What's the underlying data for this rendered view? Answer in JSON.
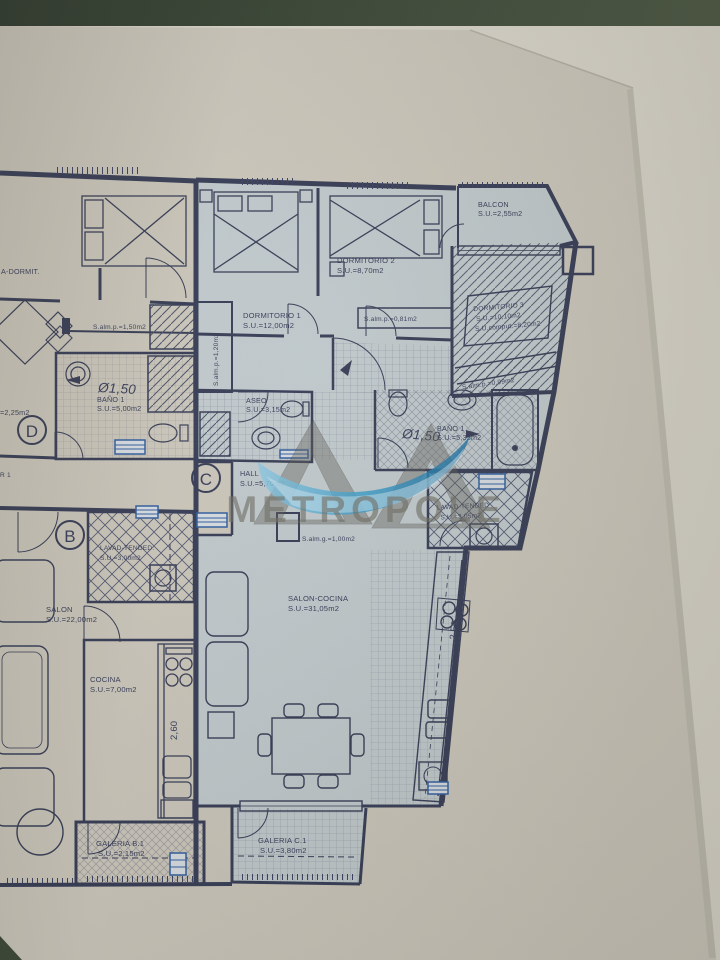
{
  "watermark": {
    "brand": "METROPOLE"
  },
  "colors": {
    "paper": "#cbc6ba",
    "paper_under": "#d8d4c9",
    "room_fill": "#c0c9cc",
    "line": "#353b54",
    "accent_blue": "#2f5d9e",
    "watermark_gray": "#6f6d64",
    "watermark_blue": "#379bc8",
    "photo_border_green": "#3b4736"
  },
  "apartment_c": {
    "stair_label": "C",
    "balcon": {
      "name": "BALCON",
      "area": "S.U.=2,55m2"
    },
    "dormitorio_1": {
      "name": "DORMITORIO 1",
      "area": "S.U.=12,00m2"
    },
    "dormitorio_2": {
      "name": "DORMITORIO 2",
      "area": "S.U.=8,70m2"
    },
    "dormitorio_3": {
      "name": "DORMITORIO 3",
      "area": "S.U.=10,10m2",
      "area_comput": "S.U.comput.=8,20m2"
    },
    "aseo": {
      "name": "ASEO",
      "area": "S.U.=3,15m2"
    },
    "bano_1": {
      "name": "BAÑO 1",
      "area": "S.U.=5,35m2",
      "shower_diameter": "Ø1,50"
    },
    "hall": {
      "name": "HALL",
      "area": "S.U.=5,70m2"
    },
    "lavadero_tendedero": {
      "name": "LAVAD-TENDED",
      "area": "S.U.=3,05m2"
    },
    "salon_cocina": {
      "name": "SALON-COCINA",
      "area": "S.U.=31,05m2"
    },
    "galeria": {
      "name": "GALERIA C.1",
      "area": "S.U.=3,80m2"
    },
    "storage_p_081": "S.alm.p.=0,81m2",
    "storage_p_099": "S.alm.p.=0,99m2",
    "storage_p_120": "S.alm.p.=1,20m2",
    "storage_g_100": "S.alm.g.=1,00m2",
    "kitchen_dim": "2,53"
  },
  "apartment_b": {
    "stair_label": "B",
    "salon": {
      "name": "SALON",
      "area": "S.U.=22,00m2"
    },
    "cocina": {
      "name": "COCINA",
      "area": "S.U.=7,00m2"
    },
    "lavadero_tendedero": {
      "name": "LAVAD-TENDED.",
      "area": "S.U.=3,00m2"
    },
    "galeria": {
      "name": "GALERIA B.1",
      "area": "S.U.=2,15m2"
    },
    "bano_1": {
      "name": "BAÑO 1",
      "area": "S.U.=5,00m2",
      "shower_diameter": "Ø1,50"
    },
    "storage_p_150": "S.alm.p.=1,50m2",
    "kitchen_dim": "2,60"
  },
  "apartment_d": {
    "stair_label": "D",
    "dormit_label_partial": "A-DORMIT.",
    "area_label_partial": "=2,25m2",
    "room_label_partial": "R 1"
  }
}
